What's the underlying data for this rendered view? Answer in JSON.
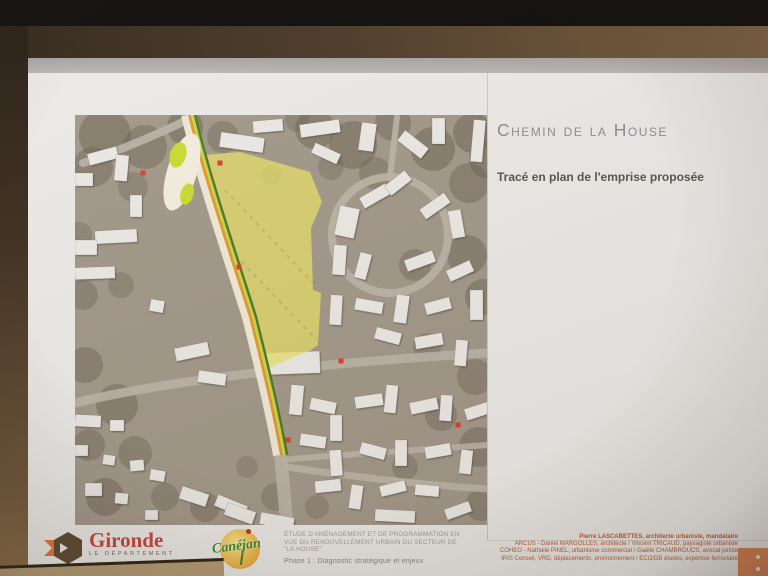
{
  "slide": {
    "title": "Chemin de la House",
    "subtitle": "Tracé en plan de l'emprise proposée",
    "footer": {
      "gironde": {
        "name": "Gironde",
        "dept": "LE DÉPARTEMENT",
        "url": "gironde.fr"
      },
      "canejan": {
        "name": "Canéjan"
      },
      "study_lines": [
        "ÉTUDE D'AMÉNAGEMENT ET DE PROGRAMMATION EN",
        "VUE DU RENOUVELLEMENT URBAIN DU SECTEUR DE",
        "\"LA HOUSE\""
      ],
      "phase": "Phase 1 : Diagnostic stratégique et enjeux",
      "credits": [
        "Pierre LASCABETTES, architecte urbaniste, mandataire",
        "ARCUS - Daniel MARGOLLES, architecte / Vincent TRICAUD, paysagiste urbaniste",
        "COHEO - Nathalie PINEL, urbanisme commercial / Gaëlle CHAMBROUCS, avocat juriste",
        "IRIS Conseil, VRD, déplacements, environnement / ECO/DB études, expertise ferroviaire"
      ],
      "corner_color": "#dd8757"
    },
    "colors": {
      "title": "#8c8c90",
      "subtitle": "#57534d",
      "credits": "#bf5b33",
      "gironde_red": "#c8473c",
      "canejan_green": "#3f8a2f"
    }
  },
  "map": {
    "bg": "#a29889",
    "vegetation_color": "#6b6152",
    "road_color": "#bdb5a9",
    "building_color": "#eceae6",
    "highlight_color": "#e8e06a",
    "marker_color": "#d6402a",
    "vegetation": [
      [
        30,
        20,
        26,
        0.5
      ],
      [
        70,
        32,
        22,
        0.45
      ],
      [
        110,
        12,
        18,
        0.5
      ],
      [
        18,
        52,
        20,
        0.45
      ],
      [
        148,
        22,
        16,
        0.4
      ],
      [
        58,
        72,
        15,
        0.35
      ],
      [
        240,
        14,
        20,
        0.5
      ],
      [
        278,
        30,
        24,
        0.5
      ],
      [
        318,
        8,
        18,
        0.45
      ],
      [
        358,
        34,
        22,
        0.5
      ],
      [
        398,
        18,
        20,
        0.5
      ],
      [
        300,
        58,
        16,
        0.4
      ],
      [
        394,
        68,
        20,
        0.45
      ],
      [
        256,
        52,
        13,
        0.35
      ],
      [
        412,
        45,
        18,
        0.45
      ],
      [
        340,
        150,
        16,
        0.4
      ],
      [
        392,
        140,
        20,
        0.45
      ],
      [
        408,
        182,
        18,
        0.45
      ],
      [
        352,
        232,
        14,
        0.35
      ],
      [
        400,
        262,
        18,
        0.4
      ],
      [
        366,
        300,
        16,
        0.4
      ],
      [
        404,
        332,
        20,
        0.45
      ],
      [
        330,
        352,
        13,
        0.35
      ],
      [
        406,
        390,
        16,
        0.4
      ],
      [
        8,
        180,
        15,
        0.4
      ],
      [
        46,
        170,
        13,
        0.35
      ],
      [
        10,
        250,
        18,
        0.45
      ],
      [
        42,
        290,
        21,
        0.45
      ],
      [
        14,
        330,
        16,
        0.4
      ],
      [
        60,
        338,
        17,
        0.4
      ],
      [
        30,
        382,
        19,
        0.45
      ],
      [
        90,
        382,
        14,
        0.35
      ],
      [
        130,
        392,
        15,
        0.4
      ],
      [
        4,
        120,
        13,
        0.35
      ],
      [
        200,
        382,
        14,
        0.35
      ],
      [
        242,
        392,
        12,
        0.3
      ],
      [
        172,
        352,
        11,
        0.3
      ],
      [
        222,
        5,
        12,
        0.35
      ],
      [
        196,
        60,
        10,
        0.3
      ]
    ],
    "roads": [
      {
        "d": "M8,48 Q60,30 110,6",
        "w": 8
      },
      {
        "d": "M113,0 C128,62 152,132 174,202 C188,258 199,302 206,345 L212,410",
        "w": 13
      },
      {
        "d": "M0,288 C90,266 240,248 412,238",
        "w": 9
      },
      {
        "d": "M257,120 a58,58 0 1,0 116,0 a58,58 0 1,0 -116,0",
        "w": 8
      },
      {
        "d": "M212,352 C280,362 350,370 412,374",
        "w": 7
      },
      {
        "d": "M315,62 L322,2",
        "w": 6
      },
      {
        "d": "M206,345 C260,340 330,336 412,330",
        "w": 6
      }
    ],
    "buildings": [
      [
        0,
        58,
        18,
        13,
        0
      ],
      [
        13,
        35,
        30,
        12,
        -15
      ],
      [
        40,
        40,
        13,
        26,
        5
      ],
      [
        55,
        80,
        12,
        22,
        0
      ],
      [
        20,
        115,
        42,
        13,
        -3
      ],
      [
        0,
        125,
        22,
        15,
        0
      ],
      [
        0,
        152,
        40,
        12,
        -2
      ],
      [
        75,
        185,
        14,
        12,
        10
      ],
      [
        100,
        230,
        34,
        13,
        -12
      ],
      [
        123,
        257,
        28,
        12,
        8
      ],
      [
        145,
        20,
        44,
        15,
        8
      ],
      [
        178,
        5,
        30,
        12,
        -5
      ],
      [
        225,
        7,
        40,
        13,
        -8
      ],
      [
        237,
        33,
        28,
        11,
        25
      ],
      [
        285,
        8,
        15,
        28,
        8
      ],
      [
        323,
        23,
        30,
        13,
        38
      ],
      [
        357,
        3,
        13,
        26,
        0
      ],
      [
        397,
        5,
        12,
        42,
        5
      ],
      [
        262,
        92,
        20,
        30,
        12
      ],
      [
        285,
        75,
        30,
        12,
        -30
      ],
      [
        310,
        62,
        26,
        12,
        -38
      ],
      [
        345,
        85,
        30,
        12,
        -35
      ],
      [
        375,
        95,
        13,
        28,
        -10
      ],
      [
        258,
        130,
        13,
        30,
        4
      ],
      [
        282,
        138,
        12,
        26,
        15
      ],
      [
        330,
        140,
        30,
        12,
        -20
      ],
      [
        372,
        150,
        26,
        12,
        -25
      ],
      [
        255,
        180,
        12,
        30,
        3
      ],
      [
        280,
        185,
        28,
        12,
        10
      ],
      [
        320,
        180,
        13,
        28,
        8
      ],
      [
        350,
        185,
        26,
        12,
        -15
      ],
      [
        395,
        175,
        13,
        30,
        0
      ],
      [
        300,
        215,
        26,
        12,
        15
      ],
      [
        340,
        220,
        28,
        12,
        -10
      ],
      [
        380,
        225,
        12,
        26,
        5
      ],
      [
        187,
        237,
        58,
        22,
        -2
      ],
      [
        215,
        270,
        13,
        30,
        5
      ],
      [
        235,
        285,
        26,
        12,
        12
      ],
      [
        255,
        300,
        12,
        26,
        0
      ],
      [
        280,
        280,
        28,
        12,
        -8
      ],
      [
        310,
        270,
        12,
        28,
        6
      ],
      [
        335,
        285,
        28,
        12,
        -12
      ],
      [
        365,
        280,
        12,
        26,
        4
      ],
      [
        390,
        290,
        26,
        12,
        -18
      ],
      [
        225,
        320,
        26,
        12,
        8
      ],
      [
        255,
        335,
        12,
        26,
        -4
      ],
      [
        285,
        330,
        26,
        12,
        15
      ],
      [
        320,
        325,
        12,
        26,
        0
      ],
      [
        350,
        330,
        26,
        12,
        -10
      ],
      [
        385,
        335,
        12,
        24,
        6
      ],
      [
        240,
        365,
        26,
        12,
        -6
      ],
      [
        275,
        370,
        12,
        24,
        8
      ],
      [
        305,
        368,
        26,
        11,
        -14
      ],
      [
        340,
        370,
        24,
        11,
        5
      ],
      [
        300,
        395,
        40,
        12,
        3
      ],
      [
        370,
        390,
        26,
        11,
        -20
      ],
      [
        0,
        300,
        26,
        12,
        3
      ],
      [
        35,
        305,
        14,
        11,
        0
      ],
      [
        0,
        330,
        13,
        11,
        0
      ],
      [
        28,
        340,
        12,
        10,
        8
      ],
      [
        55,
        345,
        14,
        11,
        -5
      ],
      [
        75,
        355,
        15,
        11,
        10
      ],
      [
        10,
        368,
        17,
        13,
        0
      ],
      [
        40,
        378,
        13,
        11,
        5
      ],
      [
        105,
        375,
        28,
        13,
        18
      ],
      [
        140,
        385,
        32,
        12,
        22
      ],
      [
        70,
        395,
        13,
        10,
        0
      ],
      [
        150,
        392,
        30,
        13,
        20
      ],
      [
        185,
        400,
        34,
        12,
        10
      ]
    ],
    "highlight_polygon": [
      [
        130,
        40
      ],
      [
        165,
        37
      ],
      [
        235,
        57
      ],
      [
        247,
        87
      ],
      [
        236,
        113
      ],
      [
        238,
        175
      ],
      [
        246,
        178
      ],
      [
        243,
        230
      ],
      [
        236,
        235
      ],
      [
        183,
        257
      ],
      [
        178,
        235
      ],
      [
        155,
        155
      ],
      [
        138,
        95
      ],
      [
        131,
        65
      ]
    ],
    "dashes": [
      {
        "d": "M150,75 L238,168"
      },
      {
        "d": "M160,140 L242,225"
      }
    ],
    "route": {
      "base": {
        "d": "M113,0 C128,62 152,132 174,202 C188,258 198,300 205,340",
        "w": 14,
        "color": "#f3ecd9"
      },
      "stripes": [
        {
          "dx": 1.5,
          "w": 3,
          "color": "#e09b2d"
        },
        {
          "dx": 4.5,
          "w": 2.5,
          "color": "#cad83e"
        },
        {
          "dx": 7,
          "w": 2.5,
          "color": "#4d7a2b"
        }
      ]
    },
    "roundabout": {
      "outer": {
        "cx": 107,
        "cy": 57,
        "rx": 15,
        "ry": 40,
        "rot": 17,
        "color": "#f4efe0"
      },
      "islands": [
        {
          "cx": 103,
          "cy": 40,
          "rx": 8,
          "ry": 13
        },
        {
          "cx": 112,
          "cy": 79,
          "rx": 6.5,
          "ry": 11
        }
      ],
      "island_color": "#ccdc30"
    },
    "markers": [
      [
        68,
        58
      ],
      [
        145,
        48
      ],
      [
        164,
        152
      ],
      [
        266,
        246
      ],
      [
        213,
        325
      ],
      [
        383,
        310
      ]
    ]
  }
}
